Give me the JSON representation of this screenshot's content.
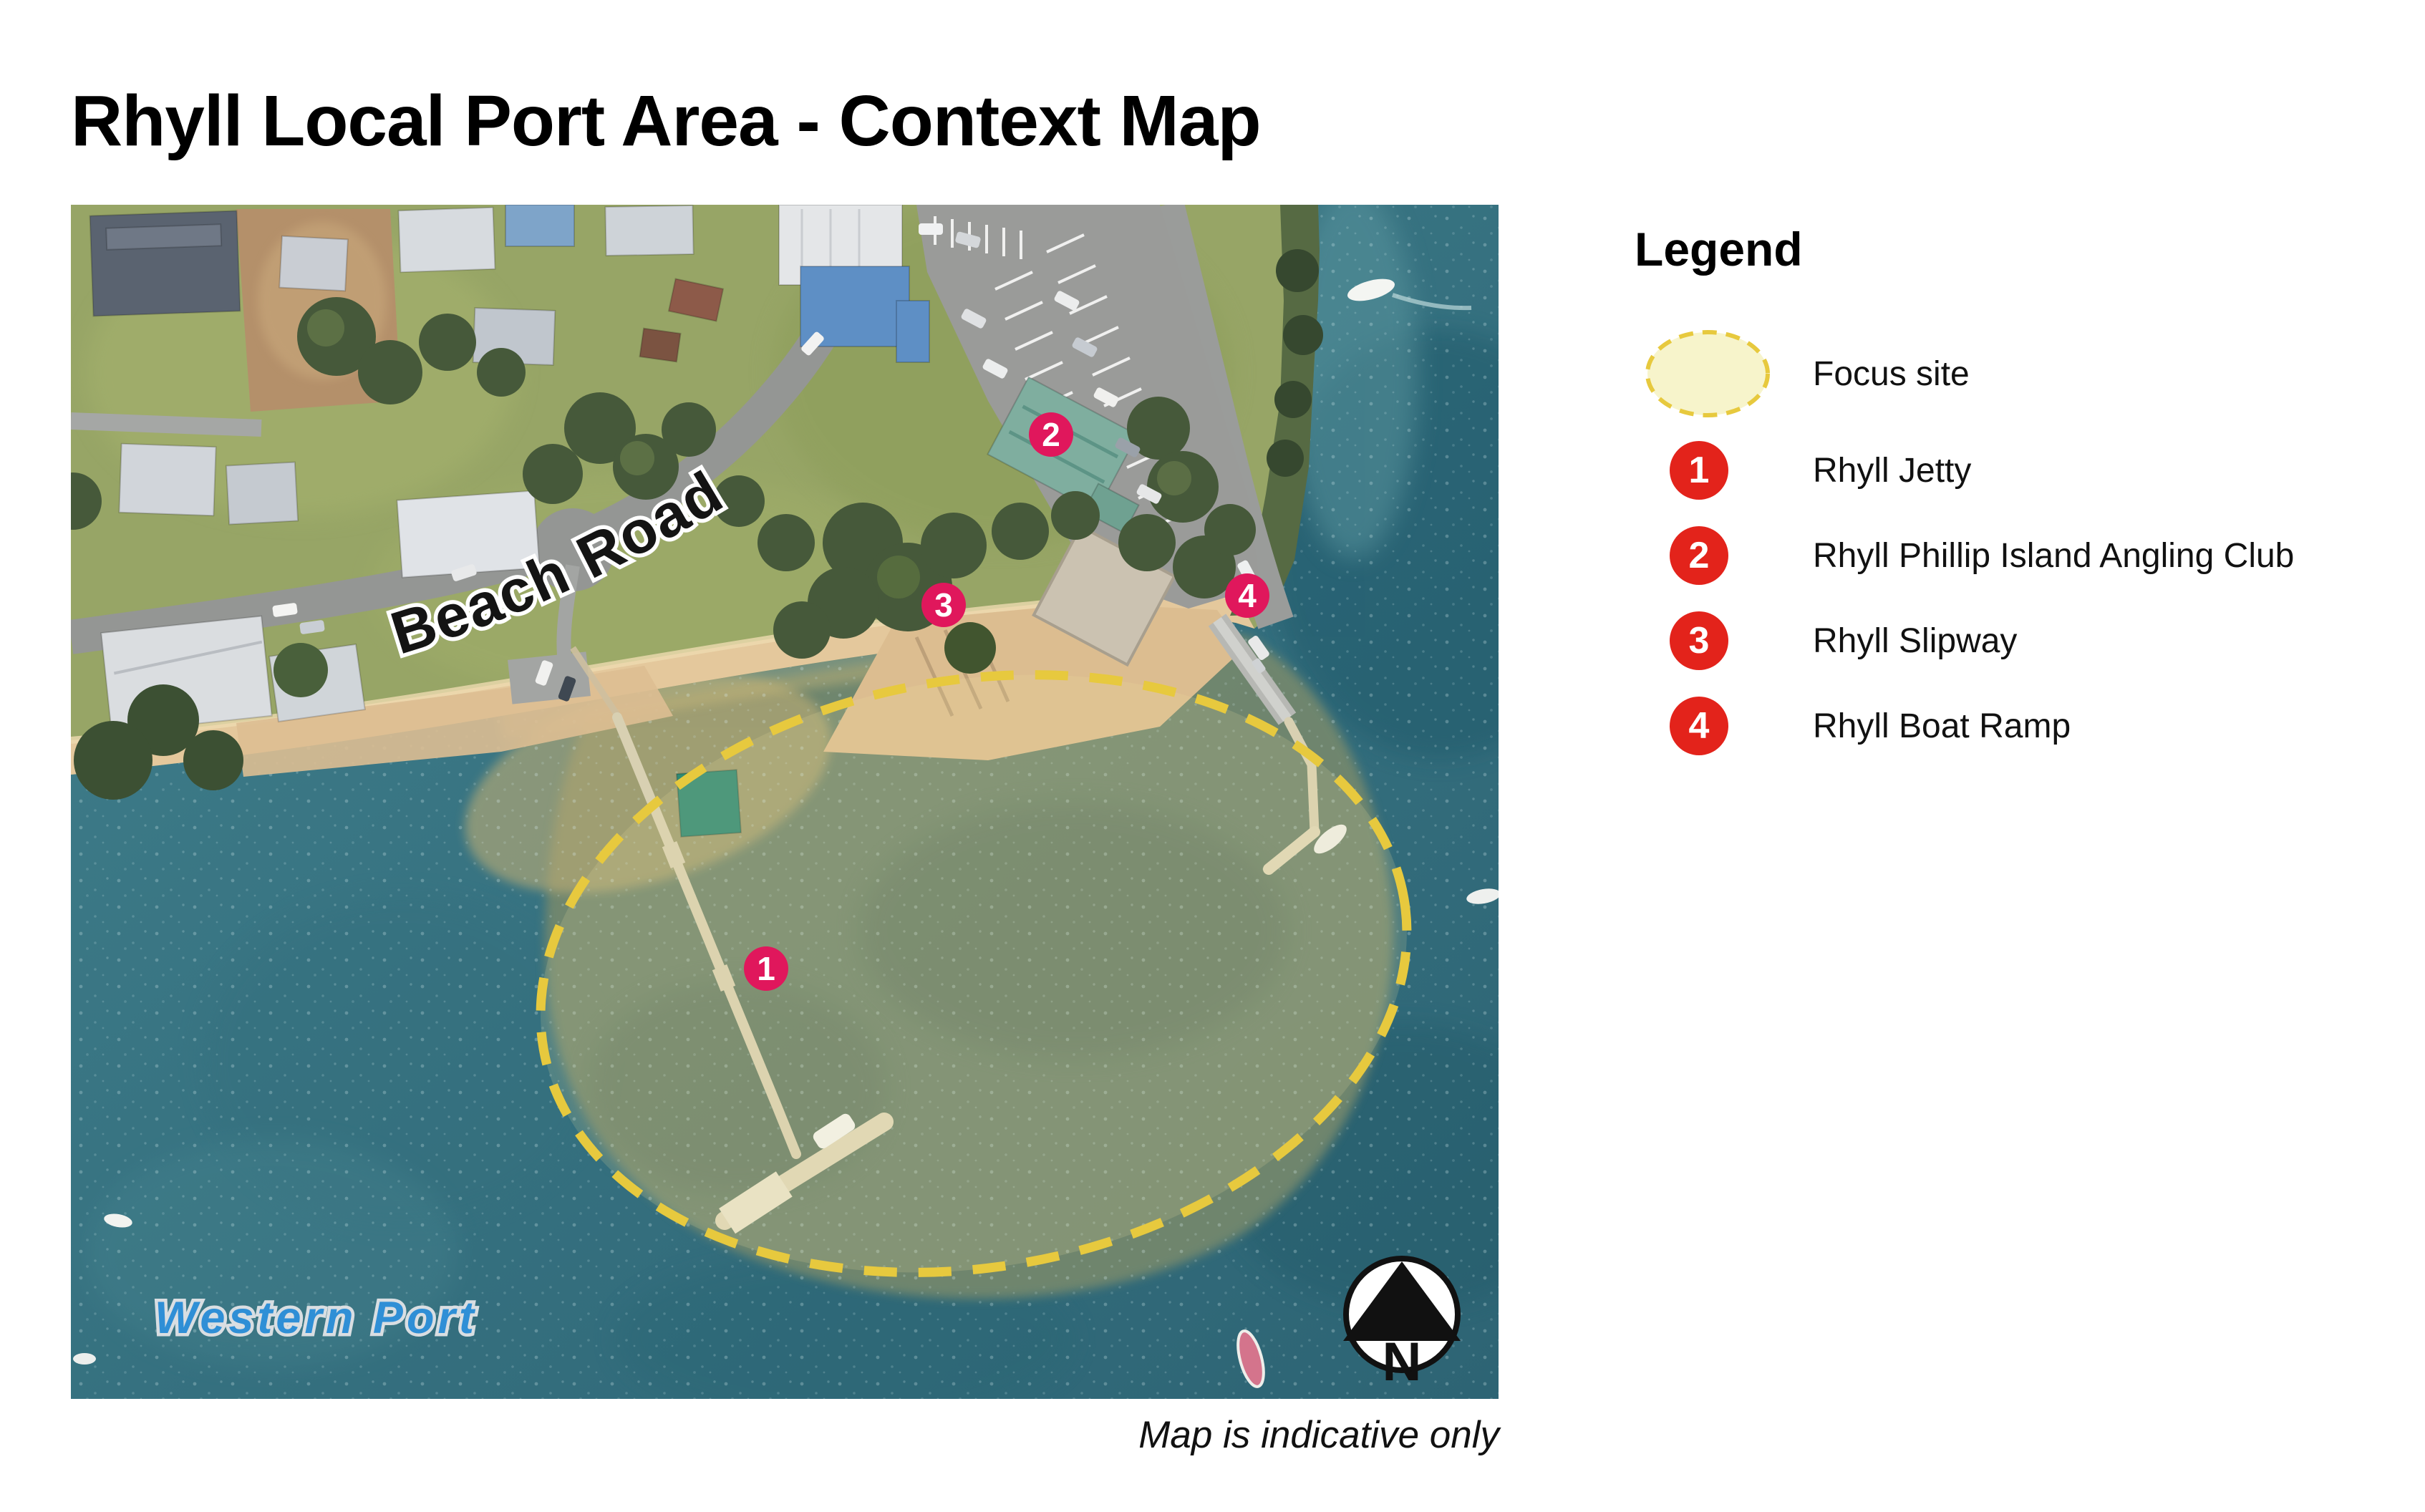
{
  "title": "Rhyll Local Port Area - Context Map",
  "legend": {
    "heading": "Legend",
    "focus_site": {
      "label": "Focus site"
    },
    "items": [
      {
        "number": "1",
        "label": "Rhyll Jetty"
      },
      {
        "number": "2",
        "label": "Rhyll Phillip Island Angling Club"
      },
      {
        "number": "3",
        "label": "Rhyll Slipway"
      },
      {
        "number": "4",
        "label": "Rhyll Boat Ramp"
      }
    ]
  },
  "map": {
    "road_label": "Beach Road",
    "water_body_label": "Western Port",
    "north_indicator": "N",
    "caption": "Map is indicative only"
  },
  "colors": {
    "legend_marker": "#e3231b",
    "map_marker": "#e0175c",
    "focus_outline": "#e7c93e",
    "focus_fill": "#f7f4cb",
    "water": "#35707f",
    "water_label": "#2f8fd6"
  }
}
